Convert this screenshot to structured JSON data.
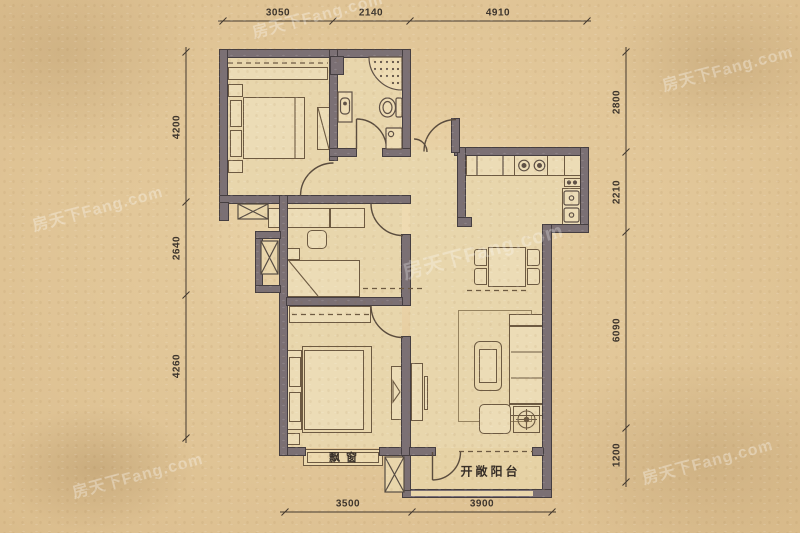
{
  "labels": {
    "bay_window": "飘窗",
    "open_balcony": "开敞阳台"
  },
  "dimensions": {
    "top": [
      "3050",
      "2140",
      "4910"
    ],
    "left": [
      "4200",
      "2640",
      "4260"
    ],
    "right": [
      "2800",
      "2210",
      "6090",
      "1200"
    ],
    "bottom": [
      "3500",
      "3900"
    ]
  },
  "watermark": {
    "text": "房天下Fang.com"
  },
  "colors": {
    "wall": "#7b7074",
    "wall_outline": "#453e41",
    "paper": "#dcc08e",
    "floor": "#e8d6ac",
    "furniture_fill": "#ecdcb6",
    "line": "#6d5a42",
    "dimension_text": "#3c342c"
  }
}
